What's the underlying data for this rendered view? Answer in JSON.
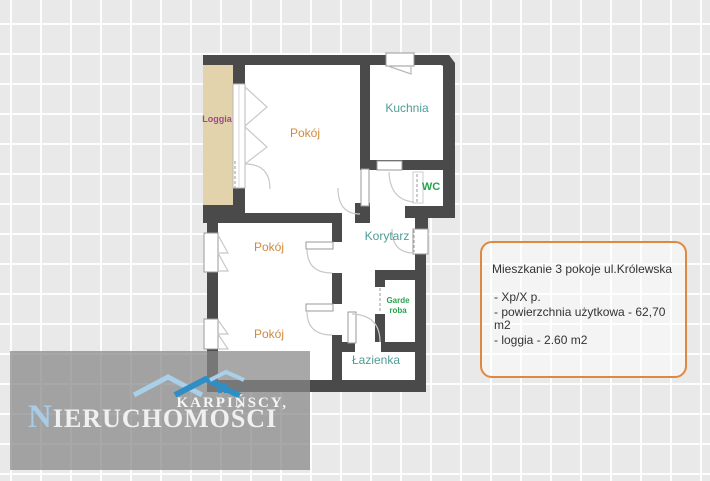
{
  "background": {
    "tile_color": "#e9e9e9",
    "grid_line_color": "#ffffff"
  },
  "floorplan": {
    "wall_color": "#4a4a4a",
    "loggia_fill": "#e3d3ac",
    "labels": {
      "loggia": "Loggia",
      "pokoj_top": "Pokój",
      "kuchnia": "Kuchnia",
      "wc": "WC",
      "korytarz": "Korytarz",
      "pokoj_middle": "Pokój",
      "garderoba_line1": "Garde",
      "garderoba_line2": "roba",
      "pokoj_bottom": "Pokój",
      "lazienka": "Łazienka"
    },
    "label_colors": {
      "loggia": "#9c4a85",
      "pokoj": "#cf8a3e",
      "teal": "#4f9d97",
      "green": "#2aa14e"
    }
  },
  "info_box": {
    "border_color": "#e0883f",
    "title": "Mieszkanie 3 pokoje ul.Królewska",
    "items": [
      "- Xp/X p.",
      "- powierzchnia użytkowa - 62,70 m2",
      "- loggia - 2.60 m2"
    ]
  },
  "logo": {
    "line1": "KARPIŃSCY,",
    "line2_initial": "N",
    "line2_rest": "IERUCHOMOŚCI",
    "initial_color": "#a9cce6",
    "roof_light": "#a9cfe9",
    "roof_dark": "#2f8fc4"
  }
}
